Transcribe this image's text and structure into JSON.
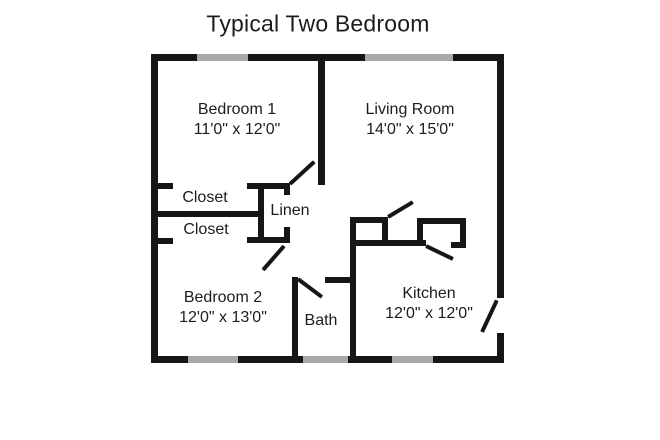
{
  "title": "Typical Two Bedroom",
  "rooms": {
    "bedroom1": {
      "name": "Bedroom 1",
      "dims": "11'0\" x 12'0\""
    },
    "living": {
      "name": "Living Room",
      "dims": "14'0\" x 15'0\""
    },
    "closet1": {
      "name": "Closet"
    },
    "closet2": {
      "name": "Closet"
    },
    "linen": {
      "name": "Linen"
    },
    "bedroom2": {
      "name": "Bedroom 2",
      "dims": "12'0\" x 13'0\""
    },
    "bath": {
      "name": "Bath"
    },
    "kitchen": {
      "name": "Kitchen",
      "dims": "12'0\" x 12'0\""
    }
  },
  "colors": {
    "wall": "#161616",
    "window": "#a9a9a9",
    "background": "#ffffff",
    "text": "#1c1c1c"
  }
}
